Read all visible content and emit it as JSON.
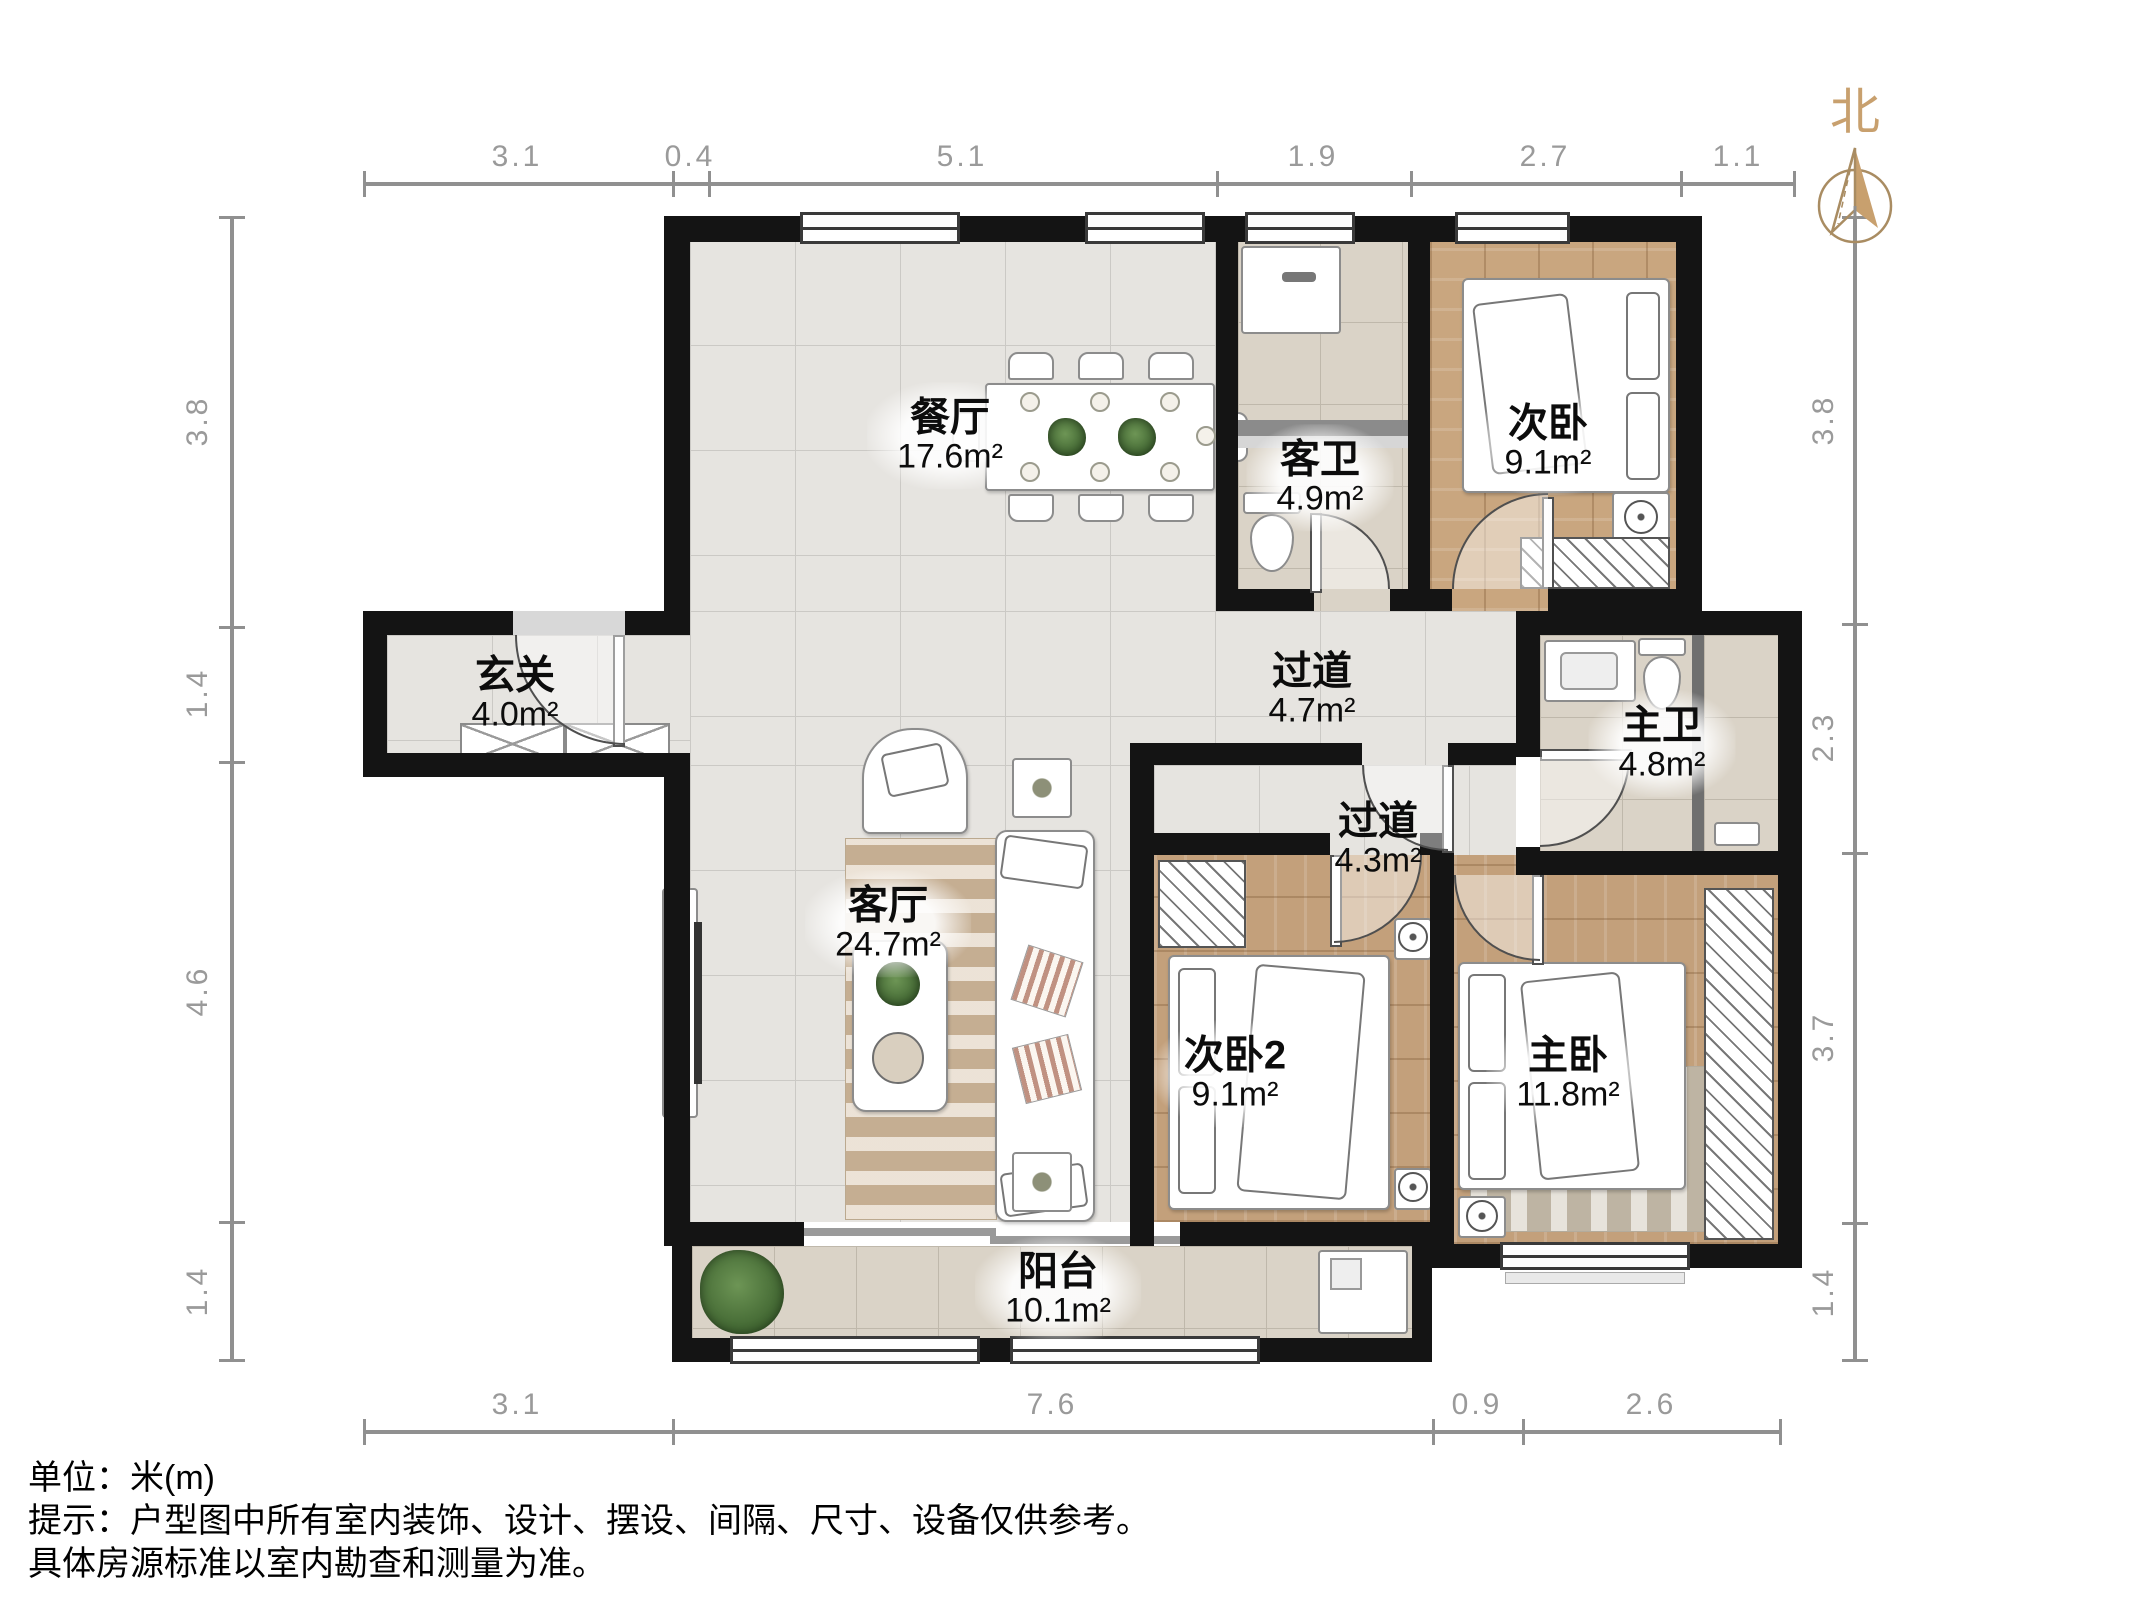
{
  "title": "户型图",
  "north_label": "北",
  "rooms": [
    {
      "id": "dining",
      "name": "餐厅",
      "area": "17.6m²"
    },
    {
      "id": "guest-bath",
      "name": "客卫",
      "area": "4.9m²"
    },
    {
      "id": "bedroom-north",
      "name": "次卧",
      "area": "9.1m²"
    },
    {
      "id": "entry",
      "name": "玄关",
      "area": "4.0m²"
    },
    {
      "id": "hallway-main",
      "name": "过道",
      "area": "4.7m²"
    },
    {
      "id": "master-bath",
      "name": "主卫",
      "area": "4.8m²"
    },
    {
      "id": "hallway-bedroom",
      "name": "过道",
      "area": "4.3m²"
    },
    {
      "id": "living",
      "name": "客厅",
      "area": "24.7m²"
    },
    {
      "id": "bedroom-2",
      "name": "次卧2",
      "area": "9.1m²"
    },
    {
      "id": "master-bedroom",
      "name": "主卧",
      "area": "11.8m²"
    },
    {
      "id": "balcony",
      "name": "阳台",
      "area": "10.1m²"
    }
  ],
  "dimensions": {
    "unit": "米(m)",
    "top": [
      "3.1",
      "0.4",
      "5.1",
      "1.9",
      "2.7",
      "1.1"
    ],
    "bottom": [
      "3.1",
      "7.6",
      "0.9",
      "2.6"
    ],
    "left": [
      "3.8",
      "1.4",
      "4.6",
      "1.4"
    ],
    "right": [
      "3.8",
      "2.3",
      "3.7",
      "1.4"
    ]
  },
  "footnotes": [
    "单位：米(m)",
    "提示：户型图中所有室内装饰、设计、摆设、间隔、尺寸、设备仅供参考。",
    "具体房源标准以室内勘查和测量为准。"
  ],
  "colors": {
    "wall": "#141414",
    "tile_light": "#e6e4e0",
    "tile_bath": "#dad3c7",
    "wood": "#c9a67f",
    "north_arrow": "#c8a06e",
    "dimension": "#909090"
  }
}
